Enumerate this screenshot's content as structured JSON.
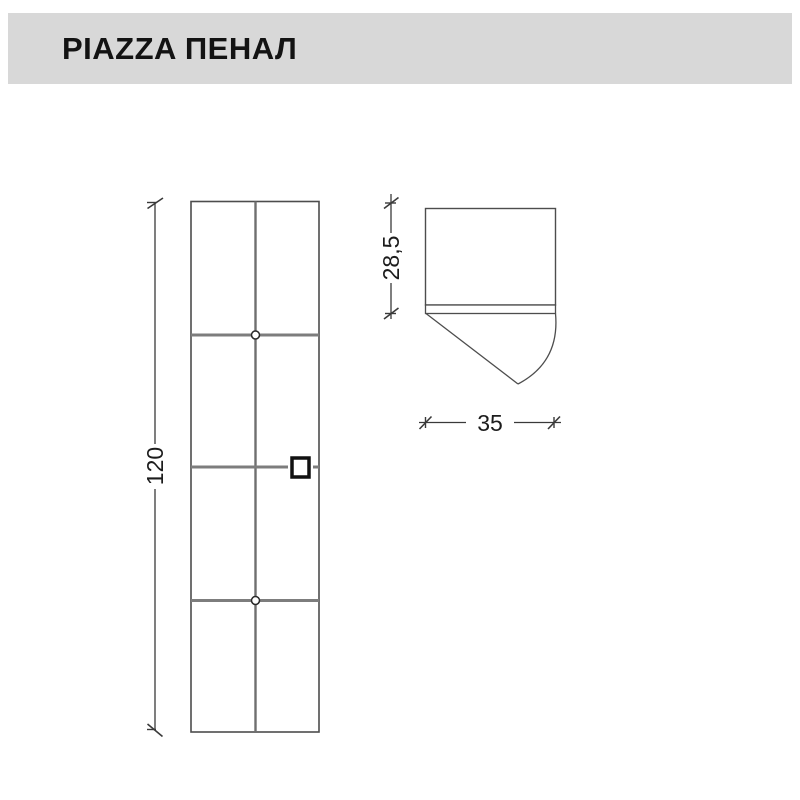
{
  "header": {
    "title": "PIAZZA ПЕНАЛ",
    "background": "#d8d8d8",
    "text_color": "#131313"
  },
  "drawing": {
    "dimensions": {
      "height_cm": "120",
      "depth_cm": "28,5",
      "width_cm": "35"
    },
    "colors": {
      "outline": "#4d4d4d",
      "panel_line": "#7d7d7d",
      "dimension_line": "#3a3a3a",
      "handle": "#111111"
    }
  }
}
